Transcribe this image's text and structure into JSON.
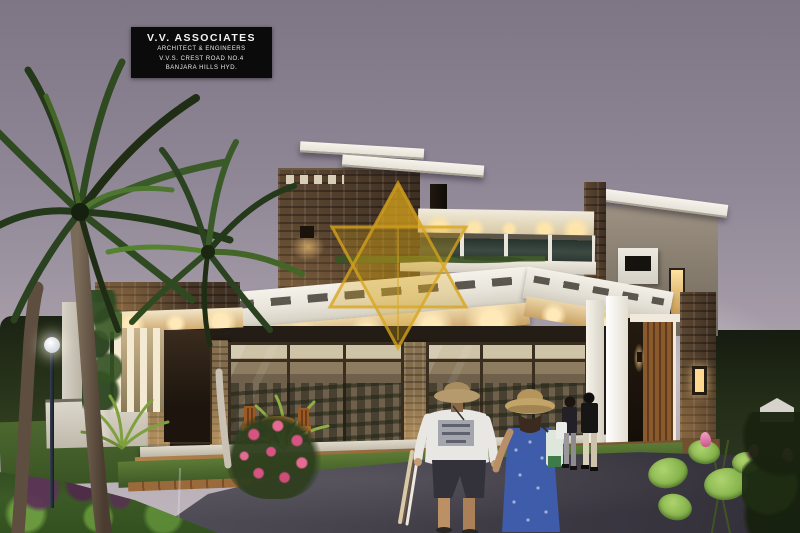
{
  "banner": {
    "title": "V.V. ASSOCIATES",
    "lines": [
      "ARCHITECT  & ENGINEERS",
      "V.V.S. CREST ROAD NO.4",
      "BANJARA HILLS HYD."
    ]
  },
  "watermark": {
    "shape": "double-triangle-monogram",
    "color": "#d8a41c"
  },
  "palette": {
    "sky_top": "#7e7685",
    "sky_mid": "#a39aa6",
    "sky_bottom": "#bfb6bc",
    "banner_bg": "#0b0b0b",
    "banner_text": "#f2f2f2",
    "watermark_gold": "#d8a41c",
    "stone_brown": "#4f3b2a",
    "fascia_white": "#f2efe7",
    "wall_beige": "#8d8376",
    "warm_light": "#ffdf9b",
    "wood_door": "#7a4a22",
    "foliage_dark": "#1e2a14",
    "grass_green": "#4b6a2e",
    "road_gray": "#45424a",
    "curb_brick": "#8a5a33",
    "flower_pink": "#d65382",
    "dress_blue": "#3f5caa",
    "skin_tan": "#bb9064"
  }
}
